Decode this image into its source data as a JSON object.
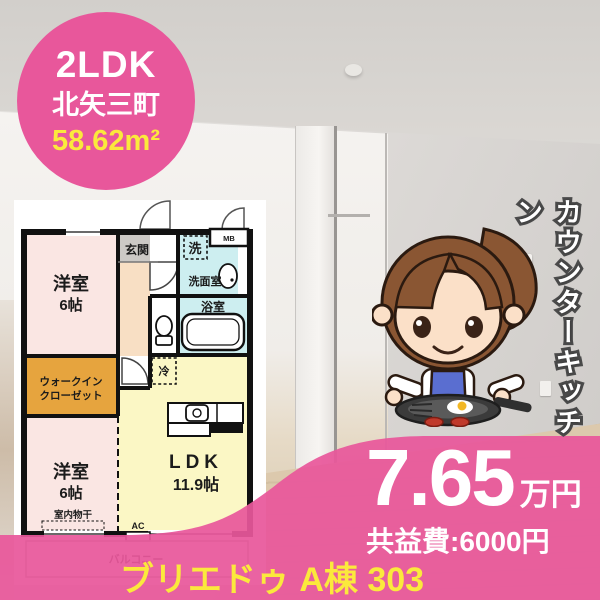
{
  "badge": {
    "layout_type": "2LDK",
    "location": "北矢三町",
    "area": "58.62m²"
  },
  "photo": {
    "vertical_caption": "カウンターキッチン"
  },
  "floorplan": {
    "rooms": {
      "bedroom1": {
        "name": "洋室",
        "size": "6帖"
      },
      "closet": {
        "line1": "ウォークイン",
        "line2": "クローゼット"
      },
      "bedroom2": {
        "name": "洋室",
        "size": "6帖"
      },
      "ldk": {
        "name": "LDK",
        "size": "11.9帖"
      }
    },
    "labels": {
      "entrance": "玄関",
      "washer": "洗",
      "washroom": "洗面室",
      "bathroom": "浴室",
      "meter_box": "MB",
      "fridge": "冷",
      "ac": "AC",
      "indoor_drying": "室内物干",
      "balcony": "バルコニー"
    }
  },
  "price": {
    "rent_value": "7.65",
    "rent_unit": "万円",
    "common_fee": "共益費:6000円"
  },
  "property_name": "ブリエドゥ A棟 303",
  "colors": {
    "accent_pink": "#e8579b",
    "accent_yellow": "#fbe93c"
  }
}
